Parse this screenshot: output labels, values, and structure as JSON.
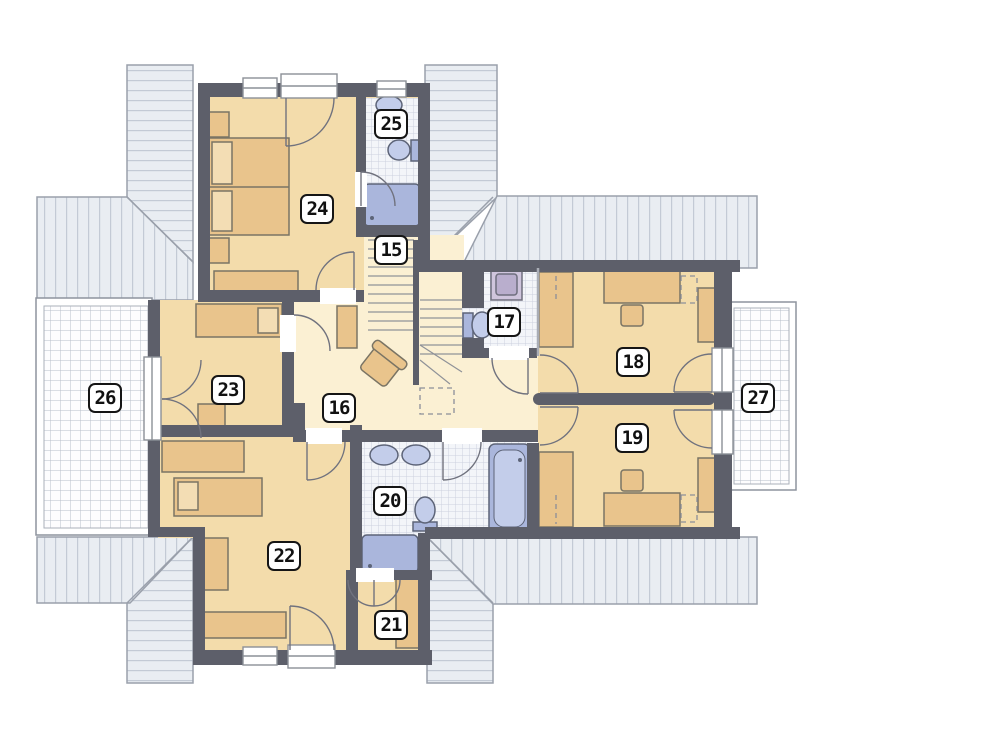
{
  "plan": {
    "type": "architectural-floor-plan-upper-storey",
    "room_labels": [
      {
        "number": "15",
        "cx": 391,
        "cy": 250
      },
      {
        "number": "16",
        "cx": 339,
        "cy": 408
      },
      {
        "number": "17",
        "cx": 504,
        "cy": 322
      },
      {
        "number": "18",
        "cx": 633,
        "cy": 362
      },
      {
        "number": "19",
        "cx": 632,
        "cy": 438
      },
      {
        "number": "20",
        "cx": 390,
        "cy": 501
      },
      {
        "number": "21",
        "cx": 391,
        "cy": 625
      },
      {
        "number": "22",
        "cx": 284,
        "cy": 556
      },
      {
        "number": "23",
        "cx": 228,
        "cy": 390
      },
      {
        "number": "24",
        "cx": 317,
        "cy": 209
      },
      {
        "number": "25",
        "cx": 391,
        "cy": 124
      },
      {
        "number": "26",
        "cx": 105,
        "cy": 398
      },
      {
        "number": "27",
        "cx": 758,
        "cy": 398
      }
    ],
    "colors": {
      "wall": "#5d5f6a",
      "room_floor": "#f3dcab",
      "hall_floor": "#fbf0d3",
      "furniture": "#e9c48c",
      "furniture_light": "#f3ddb4",
      "fixture": "#aab6dc",
      "fixture_light": "#c3cdea",
      "washing_machine": "#cfc5dd",
      "roof": "#e9edf2",
      "roof_stripe": "#c3cad5",
      "roof_outline": "#9aa0ab",
      "tile_line": "#ccd1de",
      "balcony_grid": "#b8bfca",
      "label_border": "#151515"
    }
  }
}
